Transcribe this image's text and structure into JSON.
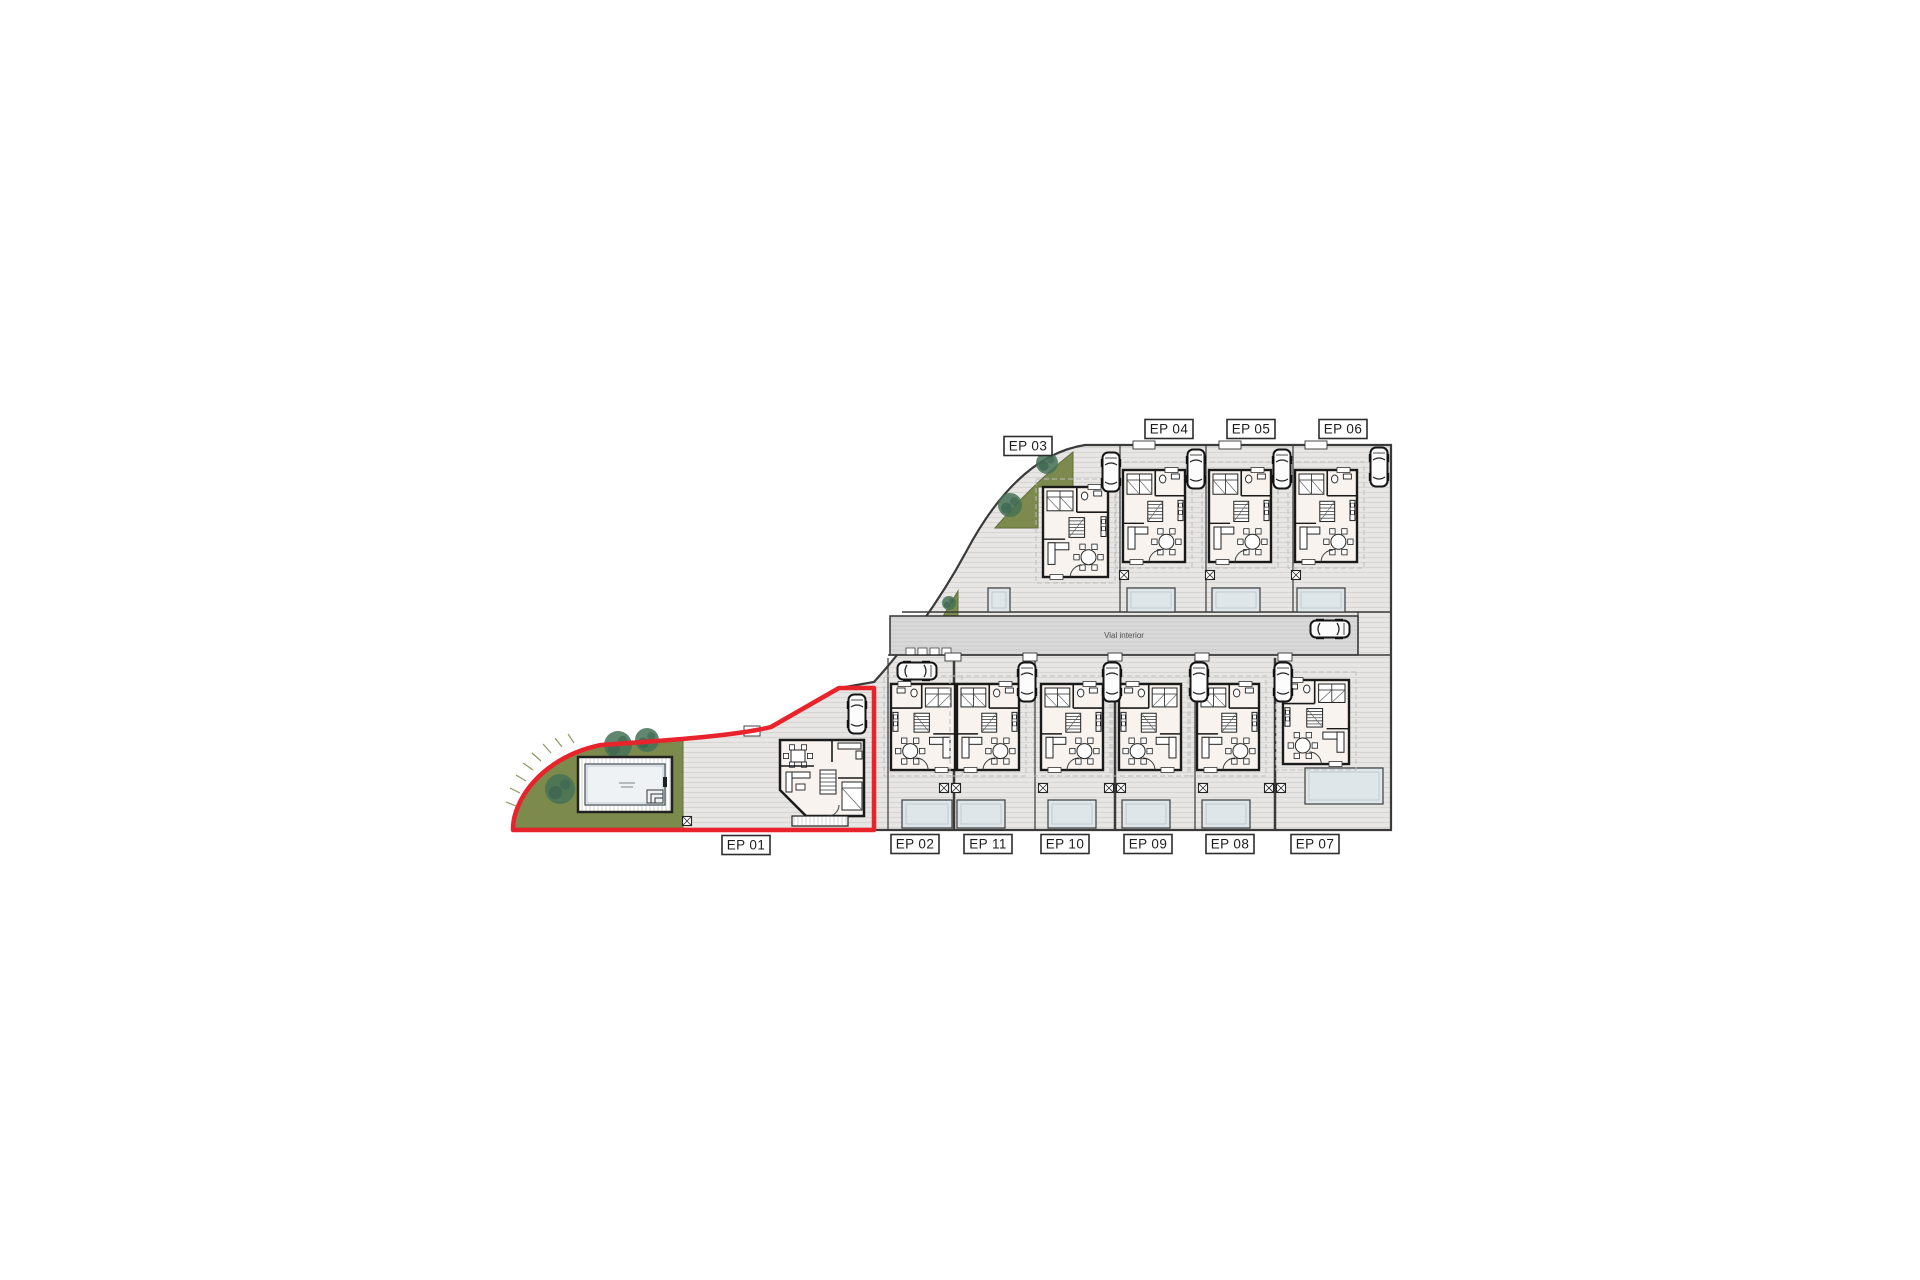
{
  "plan": {
    "road_label": "Vial interior",
    "colors": {
      "ground": "#e7e6e4",
      "ground_line": "#d2d1ce",
      "road": "#d9d9d9",
      "road_line": "#c5c5c5",
      "boundary": "#3a3a3a",
      "wall": "#1a1a1a",
      "floor": "#f8f3ee",
      "green": "#7c8b4d",
      "green_edge": "#5f6d3a",
      "tree": "#477257",
      "terrace": "#dfe6ea",
      "terrace_edge": "#3c3c3c",
      "water": "#eef2f4",
      "highlight": "#e8232b",
      "label_border": "#2d2d2d",
      "label_text": "#1d1d1d",
      "road_text": "#4f4f4f",
      "car_stroke": "#151515",
      "dash": "#bdbdbd"
    },
    "labels": [
      {
        "id": "ep01",
        "text": "EP 01",
        "x": 746,
        "y": 845
      },
      {
        "id": "ep02",
        "text": "EP 02",
        "x": 915,
        "y": 844
      },
      {
        "id": "ep11",
        "text": "EP 11",
        "x": 988,
        "y": 844
      },
      {
        "id": "ep10",
        "text": "EP 10",
        "x": 1065,
        "y": 844
      },
      {
        "id": "ep09",
        "text": "EP 09",
        "x": 1148,
        "y": 844
      },
      {
        "id": "ep08",
        "text": "EP 08",
        "x": 1230,
        "y": 844
      },
      {
        "id": "ep07",
        "text": "EP 07",
        "x": 1315,
        "y": 844
      },
      {
        "id": "ep03",
        "text": "EP 03",
        "x": 1028,
        "y": 446
      },
      {
        "id": "ep04",
        "text": "EP 04",
        "x": 1169,
        "y": 429
      },
      {
        "id": "ep05",
        "text": "EP 05",
        "x": 1251,
        "y": 429
      },
      {
        "id": "ep06",
        "text": "EP 06",
        "x": 1343,
        "y": 429
      }
    ],
    "unit_plans": [
      {
        "id": "ep03",
        "x": 1043,
        "y": 487,
        "w": 65,
        "h": 90,
        "mirror": false
      },
      {
        "id": "ep04",
        "x": 1123,
        "y": 470,
        "w": 62,
        "h": 92,
        "mirror": false
      },
      {
        "id": "ep05",
        "x": 1209,
        "y": 470,
        "w": 62,
        "h": 92,
        "mirror": false
      },
      {
        "id": "ep06",
        "x": 1295,
        "y": 470,
        "w": 62,
        "h": 92,
        "mirror": false
      },
      {
        "id": "ep02",
        "x": 891,
        "y": 684,
        "w": 64,
        "h": 86,
        "mirror": true
      },
      {
        "id": "ep11",
        "x": 957,
        "y": 684,
        "w": 62,
        "h": 86,
        "mirror": false
      },
      {
        "id": "ep10",
        "x": 1041,
        "y": 684,
        "w": 62,
        "h": 86,
        "mirror": false
      },
      {
        "id": "ep09",
        "x": 1119,
        "y": 684,
        "w": 62,
        "h": 86,
        "mirror": true
      },
      {
        "id": "ep08",
        "x": 1197,
        "y": 684,
        "w": 62,
        "h": 86,
        "mirror": false
      },
      {
        "id": "ep07",
        "x": 1283,
        "y": 680,
        "w": 66,
        "h": 84,
        "mirror": true
      }
    ],
    "villa_ep01": {
      "x": 780,
      "y": 740,
      "w": 84,
      "h": 76
    },
    "terraces": [
      {
        "x": 988,
        "y": 588,
        "w": 22,
        "h": 24
      },
      {
        "x": 1127,
        "y": 588,
        "w": 48,
        "h": 24
      },
      {
        "x": 1212,
        "y": 588,
        "w": 48,
        "h": 24
      },
      {
        "x": 1297,
        "y": 588,
        "w": 48,
        "h": 24
      },
      {
        "x": 902,
        "y": 800,
        "w": 50,
        "h": 28
      },
      {
        "x": 957,
        "y": 800,
        "w": 48,
        "h": 28
      },
      {
        "x": 1048,
        "y": 800,
        "w": 48,
        "h": 28
      },
      {
        "x": 1122,
        "y": 800,
        "w": 48,
        "h": 28
      },
      {
        "x": 1202,
        "y": 800,
        "w": 48,
        "h": 28
      },
      {
        "x": 1305,
        "y": 768,
        "w": 78,
        "h": 36
      }
    ],
    "cars": [
      {
        "x": 857,
        "y": 714,
        "rot": 0
      },
      {
        "x": 1111,
        "y": 472,
        "rot": 0
      },
      {
        "x": 1196,
        "y": 469,
        "rot": 0
      },
      {
        "x": 1282,
        "y": 469,
        "rot": 0
      },
      {
        "x": 1379,
        "y": 467,
        "rot": 0
      },
      {
        "x": 1330,
        "y": 629,
        "rot": 90
      },
      {
        "x": 917,
        "y": 671,
        "rot": 90
      },
      {
        "x": 1027,
        "y": 682,
        "rot": 0
      },
      {
        "x": 1112,
        "y": 682,
        "rot": 0
      },
      {
        "x": 1199,
        "y": 682,
        "rot": 0
      },
      {
        "x": 1283,
        "y": 682,
        "rot": 0
      }
    ],
    "markers": [
      {
        "x": 687,
        "y": 821
      },
      {
        "x": 944,
        "y": 788
      },
      {
        "x": 956,
        "y": 788
      },
      {
        "x": 1043,
        "y": 788
      },
      {
        "x": 1109,
        "y": 788
      },
      {
        "x": 1121,
        "y": 788
      },
      {
        "x": 1203,
        "y": 788
      },
      {
        "x": 1269,
        "y": 788
      },
      {
        "x": 1281,
        "y": 788
      },
      {
        "x": 1124,
        "y": 575
      },
      {
        "x": 1210,
        "y": 575
      },
      {
        "x": 1296,
        "y": 575
      }
    ],
    "trees": [
      {
        "x": 618,
        "y": 745,
        "r": 14
      },
      {
        "x": 647,
        "y": 740,
        "r": 12
      },
      {
        "x": 560,
        "y": 789,
        "r": 15
      },
      {
        "x": 1010,
        "y": 505,
        "r": 12
      },
      {
        "x": 1047,
        "y": 463,
        "r": 11
      },
      {
        "x": 949,
        "y": 603,
        "r": 7
      }
    ],
    "pool": {
      "deck": {
        "x": 578,
        "y": 757,
        "w": 94,
        "h": 55
      },
      "water": {
        "x": 585,
        "y": 764,
        "w": 80,
        "h": 41
      }
    }
  }
}
